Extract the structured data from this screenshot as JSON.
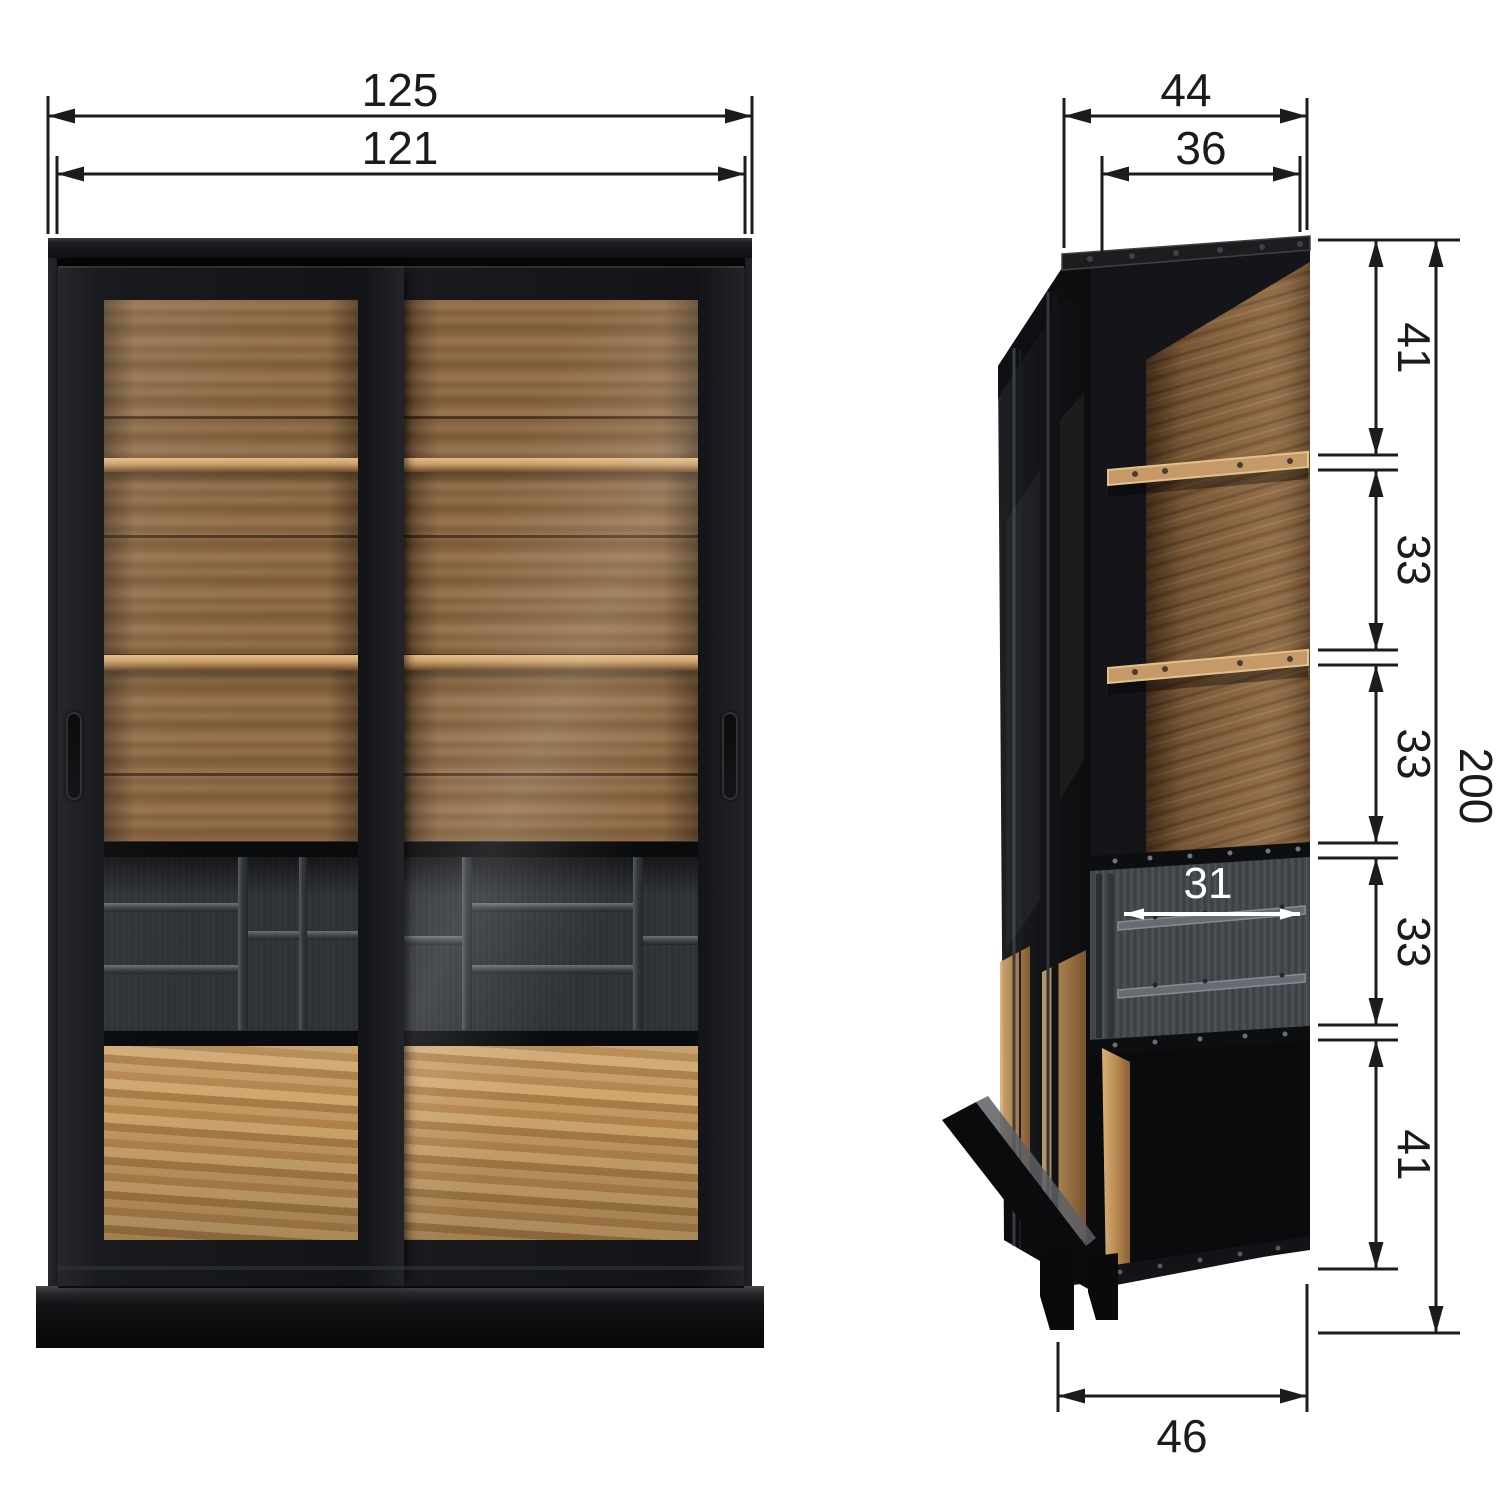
{
  "front_view": {
    "overall_width": "125",
    "inner_width": "121"
  },
  "side_view": {
    "overall_depth": "44",
    "inner_depth": "36",
    "overall_height": "200",
    "height_segments": [
      "41",
      "33",
      "33",
      "33",
      "41"
    ],
    "inner_shelf_depth": "31",
    "base_depth": "46"
  },
  "colors": {
    "frame_black": "#141518",
    "wood_back": "#8a6744",
    "wood_drawer": "#c59a63",
    "dimension_line": "#1c1c1c",
    "inner_label": "#ffffff"
  }
}
